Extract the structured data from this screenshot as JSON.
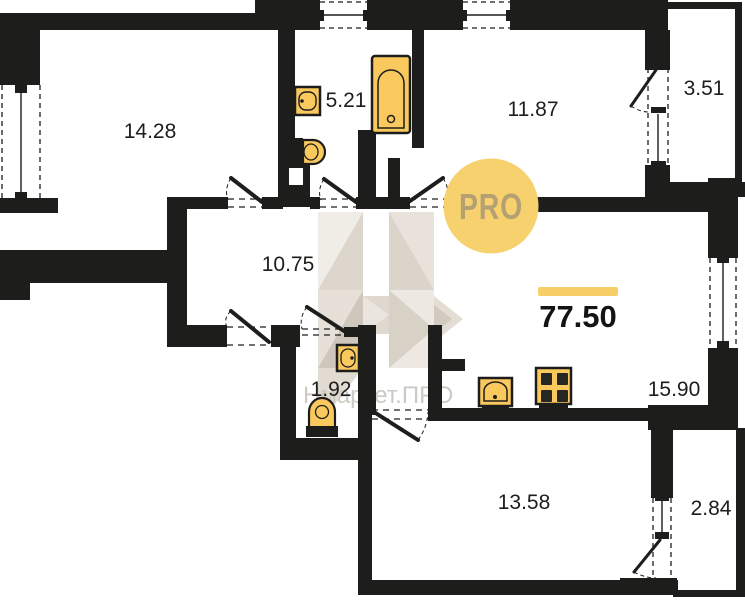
{
  "total_area": "77.50",
  "rooms": {
    "bedroom_left": {
      "area": "14.28"
    },
    "bathroom": {
      "area": "5.21"
    },
    "bedroom_top": {
      "area": "11.87"
    },
    "loggia_top": {
      "area": "3.51"
    },
    "hallway": {
      "area": "10.75"
    },
    "wc": {
      "area": "1.92"
    },
    "kitchen_living": {
      "area": "15.90"
    },
    "room_bottom": {
      "area": "13.58"
    },
    "loggia_bottom": {
      "area": "2.84"
    }
  },
  "watermarks": {
    "logo_text": "PRO",
    "brand_text": "Нмаркет.ПРО"
  },
  "icons": {
    "fixtures": [
      "bathtub-icon",
      "sink-icon",
      "toilet-icon",
      "wc-sink-icon",
      "wc-toilet-icon",
      "kitchen-sink-icon",
      "stove-icon",
      "vent-shaft"
    ]
  },
  "colors": {
    "wall": "#1d1d1b",
    "fixture_fill": "#f9c95e",
    "accent_yellow": "#f7cf68",
    "logo_circle": "#f6d16d",
    "watermark_beige": "#e6e0d8",
    "watermark_text": "#cdcac5",
    "background": "#ffffff"
  }
}
